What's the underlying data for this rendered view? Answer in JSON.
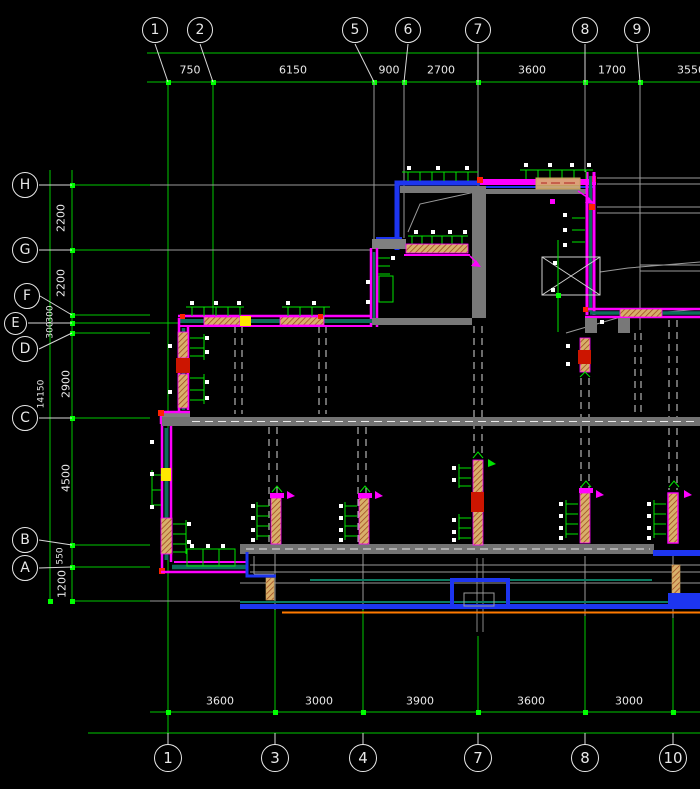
{
  "canvas": {
    "width": 700,
    "height": 789,
    "background": "#000000"
  },
  "palette": {
    "grid_green": "#00e400",
    "tick_green": "#00ff00",
    "line_white": "#e8e8e8",
    "line_gray": "#9a9a9a",
    "wall_gray": "#787878",
    "wall_magenta": "#ff00ff",
    "wall_blue": "#1d35f0",
    "wall_teal": "#0c6e5a",
    "hatch_tan": "#d8b06a",
    "accent_red": "#ff2200",
    "accent_yellow": "#ffe800",
    "accent_orange": "#ff7a00"
  },
  "axes": {
    "top_bubbles": [
      "1",
      "2",
      "5",
      "6",
      "7",
      "8",
      "9"
    ],
    "bottom_bubbles": [
      "1",
      "3",
      "4",
      "7",
      "8",
      "10"
    ],
    "row_bubbles": [
      "H",
      "G",
      "F",
      "E",
      "D",
      "C",
      "B",
      "A"
    ],
    "top_dims": [
      "750",
      "6150",
      "900",
      "2700",
      "3600",
      "1700",
      "3550"
    ],
    "bottom_dims": [
      "3600",
      "3000",
      "3900",
      "3600",
      "3000"
    ],
    "row_dims": [
      "2200",
      "2200",
      "300",
      "300",
      "2900",
      "4500",
      "550",
      "1200"
    ],
    "overall_height_dim": "14150"
  }
}
